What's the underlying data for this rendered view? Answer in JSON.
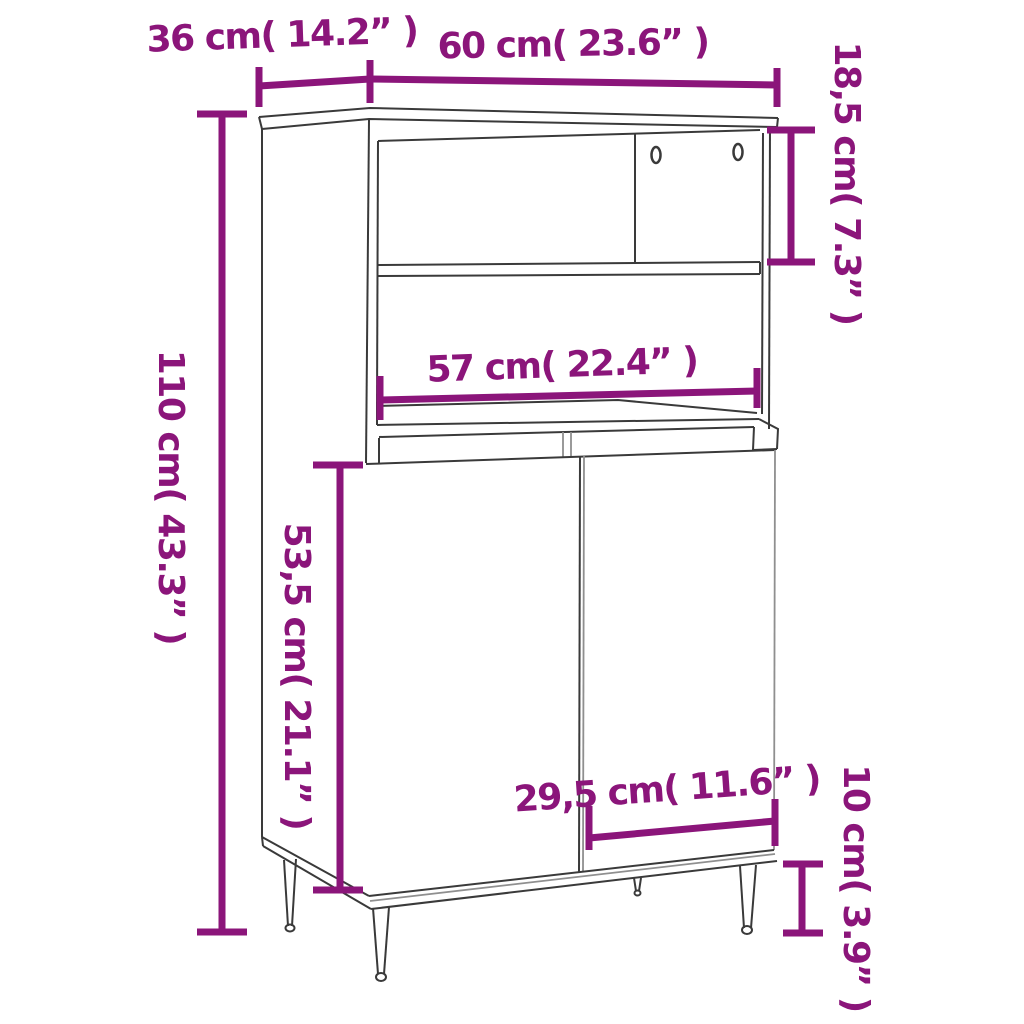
{
  "diagram": {
    "type": "furniture-dimension-diagram",
    "subject": "highboard cabinet with open shelves, two doors and tapered legs",
    "background_color": "#ffffff",
    "line_color": "#3a3a3a",
    "dimension_color": "#8B157A"
  },
  "labels": {
    "depth": "36 cm( 14.2” )",
    "width": "60 cm( 23.6” )",
    "top_compartment_height": "18,5 cm( 7.3” )",
    "total_height": "110 cm( 43.3” )",
    "inner_width": "57 cm( 22.4” )",
    "door_height": "53,5 cm( 21.1” )",
    "door_width": "29,5 cm( 11.6” )",
    "leg_height": "10 cm( 3.9” )"
  },
  "measurements": [
    {
      "name": "depth",
      "cm": "36",
      "inch": "14.2"
    },
    {
      "name": "width",
      "cm": "60",
      "inch": "23.6"
    },
    {
      "name": "top_compartment_height",
      "cm": "18,5",
      "inch": "7.3"
    },
    {
      "name": "total_height",
      "cm": "110",
      "inch": "43.3"
    },
    {
      "name": "inner_width",
      "cm": "57",
      "inch": "22.4"
    },
    {
      "name": "door_height",
      "cm": "53,5",
      "inch": "21.1"
    },
    {
      "name": "door_width",
      "cm": "29,5",
      "inch": "11.6"
    },
    {
      "name": "leg_height",
      "cm": "10",
      "inch": "3.9"
    }
  ]
}
